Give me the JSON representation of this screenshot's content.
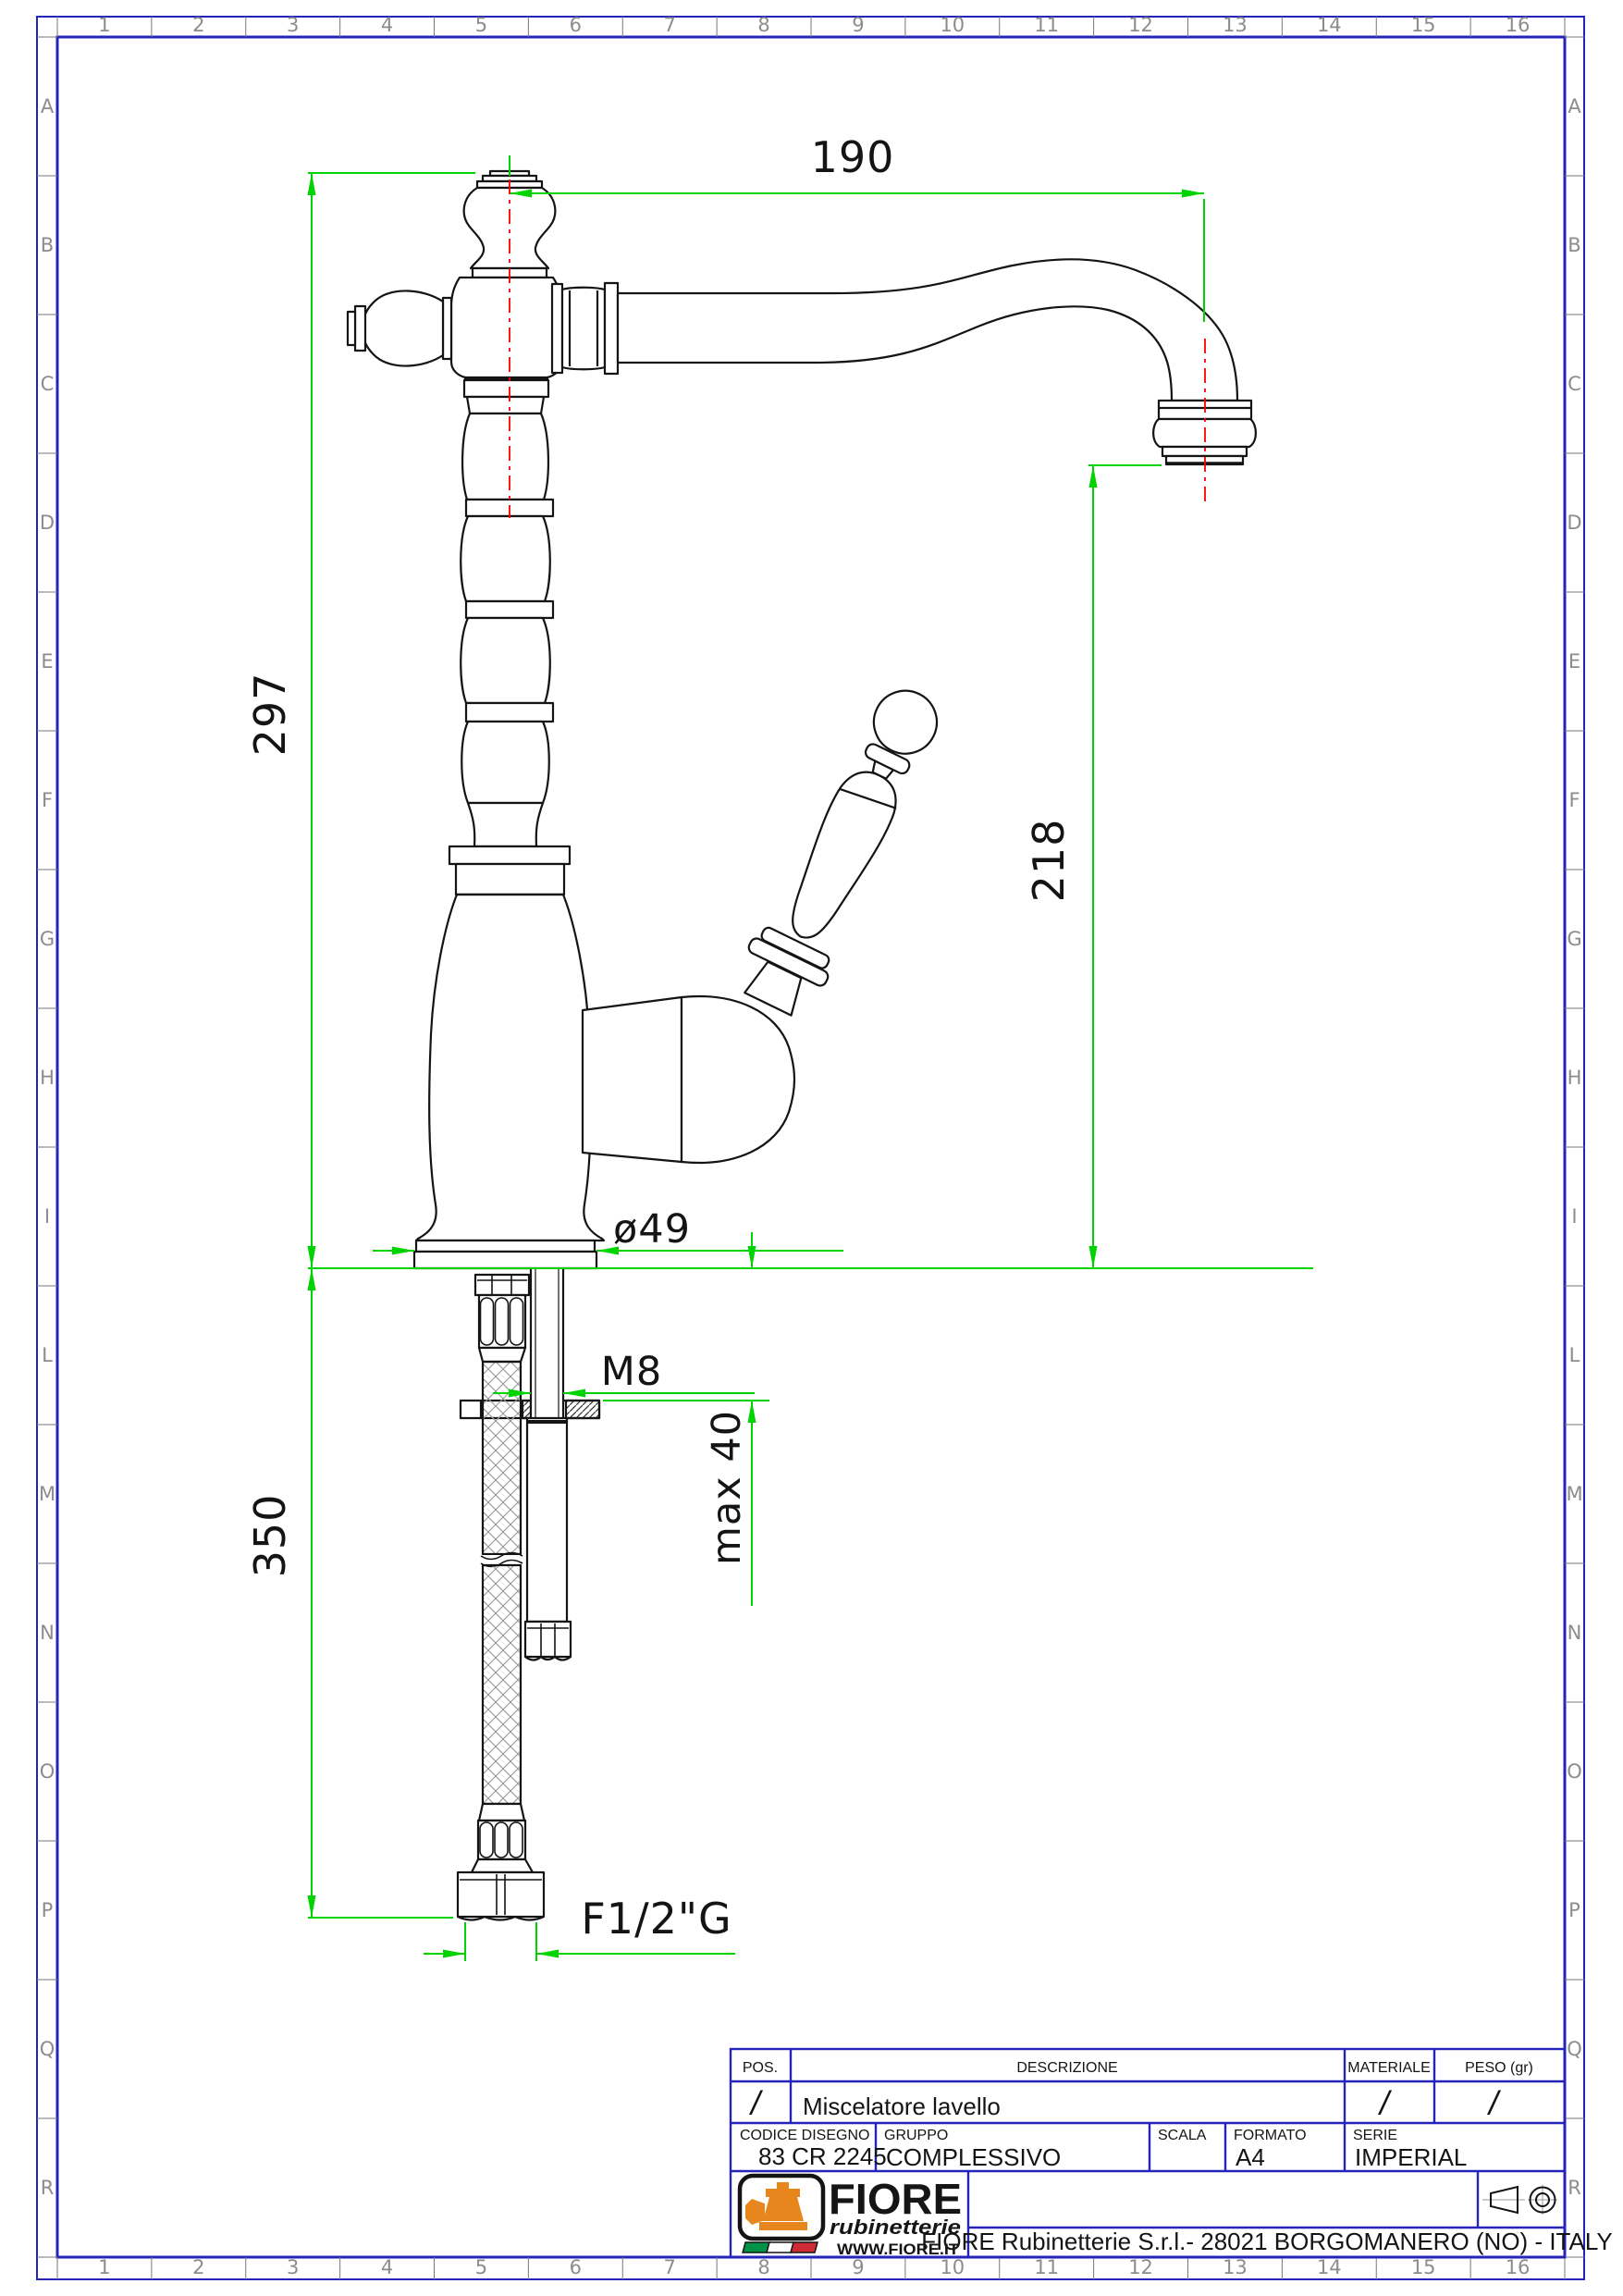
{
  "app": {
    "title": "Technical drawing - sink mixer"
  },
  "frame": {
    "border_color": "#2424bb",
    "label_color": "#8c8c8c",
    "columns": [
      "1",
      "2",
      "3",
      "4",
      "5",
      "6",
      "7",
      "8",
      "9",
      "10",
      "11",
      "12",
      "13",
      "14",
      "15",
      "16"
    ],
    "rows": [
      "A",
      "B",
      "C",
      "D",
      "E",
      "F",
      "G",
      "H",
      "I",
      "L",
      "M",
      "N",
      "O",
      "P",
      "Q",
      "R"
    ]
  },
  "dims": {
    "color": "#00d400",
    "centerline_color": "#fa0000",
    "width_top": "190",
    "height_left": "297",
    "spout_height": "218",
    "base_diameter": "ø49",
    "stud_thread": "M8",
    "counter_thickness": "max 40",
    "hose_length": "350",
    "hose_thread": "F1/2\"G"
  },
  "title_block": {
    "pos": {
      "label": "POS.",
      "value": "/"
    },
    "descrizione": {
      "label": "DESCRIZIONE",
      "value": "Miscelatore lavello"
    },
    "materiale": {
      "label": "MATERIALE",
      "value": "/"
    },
    "peso": {
      "label": "PESO (gr)",
      "value": "/"
    },
    "codice": {
      "label": "CODICE DISEGNO",
      "value": "83 CR 2245"
    },
    "gruppo": {
      "label": "GRUPPO",
      "value": "COMPLESSIVO"
    },
    "scala": {
      "label": "SCALA",
      "value": ""
    },
    "formato": {
      "label": "FORMATO",
      "value": "A4"
    },
    "serie": {
      "label": "SERIE",
      "value": "IMPERIAL"
    },
    "company": "FIORE Rubinetterie S.r.l.- 28021 BORGOMANERO (NO) - ITALY"
  },
  "logo": {
    "brand": "FIORE",
    "subtitle": "rubinetterie",
    "website": "WWW.FIORE.IT",
    "accent": "#e8861e",
    "flag_colors": [
      "#009246",
      "#ffffff",
      "#ce2b37"
    ]
  }
}
